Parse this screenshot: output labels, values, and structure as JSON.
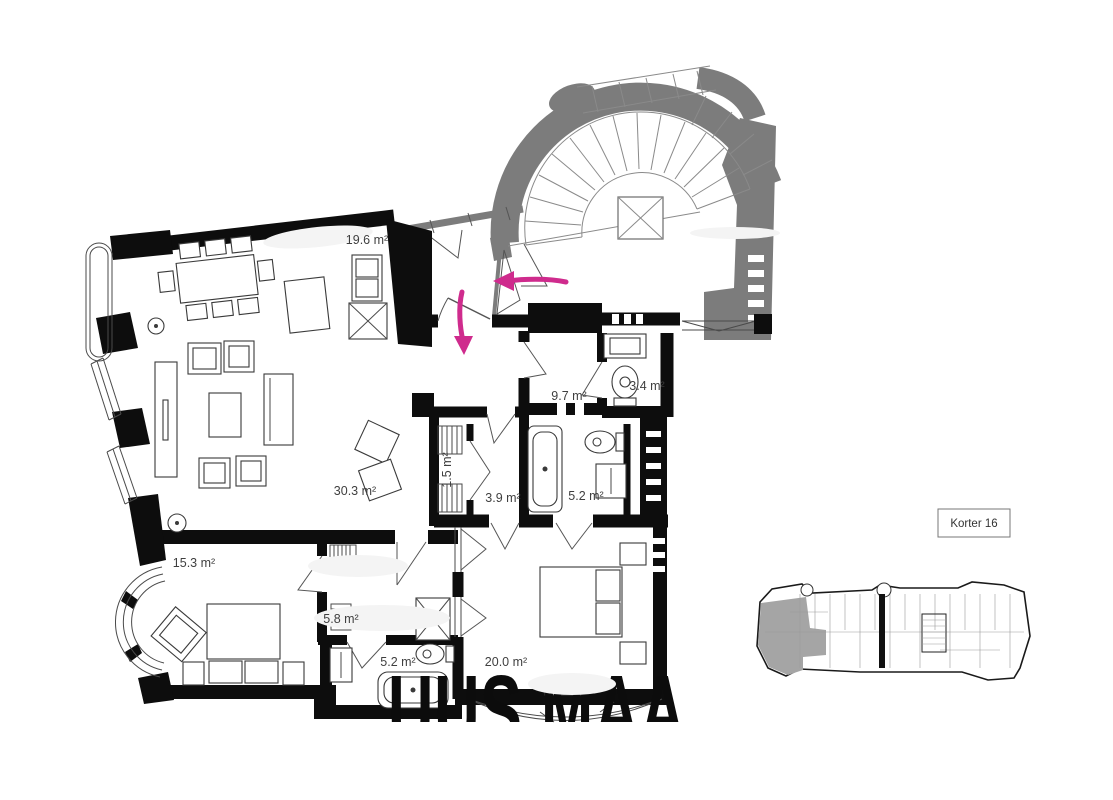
{
  "page": {
    "background": "#ffffff"
  },
  "plan": {
    "korter_label": "Korter 16",
    "watermark": "UUS MAA",
    "rooms": {
      "dining_kitchen": "19.6 m²",
      "entrance_hall": "9.7 m²",
      "wc": "3.4 m²",
      "living_room": "30.3 m²",
      "closet": "1.5 m²",
      "inner_hall": "3.9 m²",
      "bathroom_top": "5.2 m²",
      "bedroom_small": "15.3 m²",
      "back_hall": "5.8 m²",
      "bathroom_bottom": "5.2 m²",
      "bedroom_master": "20.0 m²"
    },
    "colors": {
      "walls": "#0d0d0d",
      "stairwell_gray": "#7c7c7c",
      "annotation_magenta": "#cf2b8d",
      "label_text": "#3f3f3f",
      "minimap_highlight": "#a5a5a5"
    }
  }
}
